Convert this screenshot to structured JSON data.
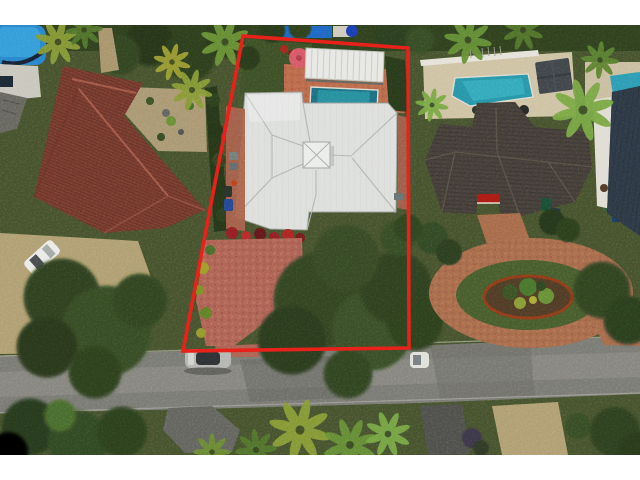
{
  "image": {
    "type": "aerial-drone-photograph",
    "subject": "single-family home with white metal hip roof, backyard pool and pergola",
    "annotation": "red property boundary outline drawn over photo",
    "framing": "white letterbox bars at top and bottom"
  },
  "colors": {
    "letterbox": "#ffffff",
    "boundary_red": "#e8211b",
    "lawn_base": "#6d7f48",
    "hedge_dark": "#3c5428",
    "canopy_green": "#4f6b36",
    "street_gray": "#9e9e9a",
    "gravel_tan": "#c6b998",
    "paver_salmon": "#c38b7f",
    "pool_deck_salmon": "#cd9070",
    "circular_drive_paver": "#bf9273",
    "white_roof": "#e7e8e6",
    "terracotta_roof": "#9b5a49",
    "dark_shingle_roof": "#696058",
    "metal_roof_blue_gray": "#47586a",
    "pergola_white": "#eeeeec",
    "pool_azure": "#3fa6d9",
    "pool_teal": "#2d95a4",
    "neighbor_pool_teal": "#3db2c0",
    "rear_pool_blue": "#2f8fd4",
    "umbrella_pink": "#e2848f",
    "umbrella_blue": "#2b5fc7",
    "bougainvillea_red": "#b23036",
    "awning_red": "#c22a20",
    "car_white": "#f0f0ee",
    "car_silver": "#c9c9c7",
    "fence_white": "#eceae4",
    "deck_cream": "#dcd3bd",
    "mulch_edge": "#b05c28"
  },
  "objects": [
    {
      "name": "boundary-outline",
      "desc": "red quadrilateral marking subject lot"
    },
    {
      "name": "subject-house-roof",
      "desc": "white standing-seam hip roof with center cupola"
    },
    {
      "name": "subject-pool",
      "desc": "teal rectangular pool behind house"
    },
    {
      "name": "pergola",
      "desc": "white ribbed patio cover by pool"
    },
    {
      "name": "pink-umbrella",
      "desc": "pink patio umbrella on back lawn"
    },
    {
      "name": "front-driveway",
      "desc": "salmon paver driveway to street"
    },
    {
      "name": "front-oak-tree",
      "desc": "large canopy over front yard"
    },
    {
      "name": "left-house-roof",
      "desc": "terracotta barrel-tile roof neighbor"
    },
    {
      "name": "top-left-pool",
      "desc": "azure pool of left rear neighbor"
    },
    {
      "name": "right-house-roof",
      "desc": "dark shingle hip roof neighbor"
    },
    {
      "name": "right-neighbor-pool",
      "desc": "teal pool with gray gazebo"
    },
    {
      "name": "circular-drive",
      "desc": "paver circular driveway with planted island"
    },
    {
      "name": "street",
      "desc": "gray asphalt street across bottom"
    },
    {
      "name": "white-suv",
      "desc": "white SUV on left gravel drive"
    },
    {
      "name": "silver-car",
      "desc": "silver sedan parked on street"
    },
    {
      "name": "trash-bins",
      "desc": "collection bins beside houses"
    },
    {
      "name": "palm-trees",
      "desc": "palms scattered across yards"
    }
  ]
}
